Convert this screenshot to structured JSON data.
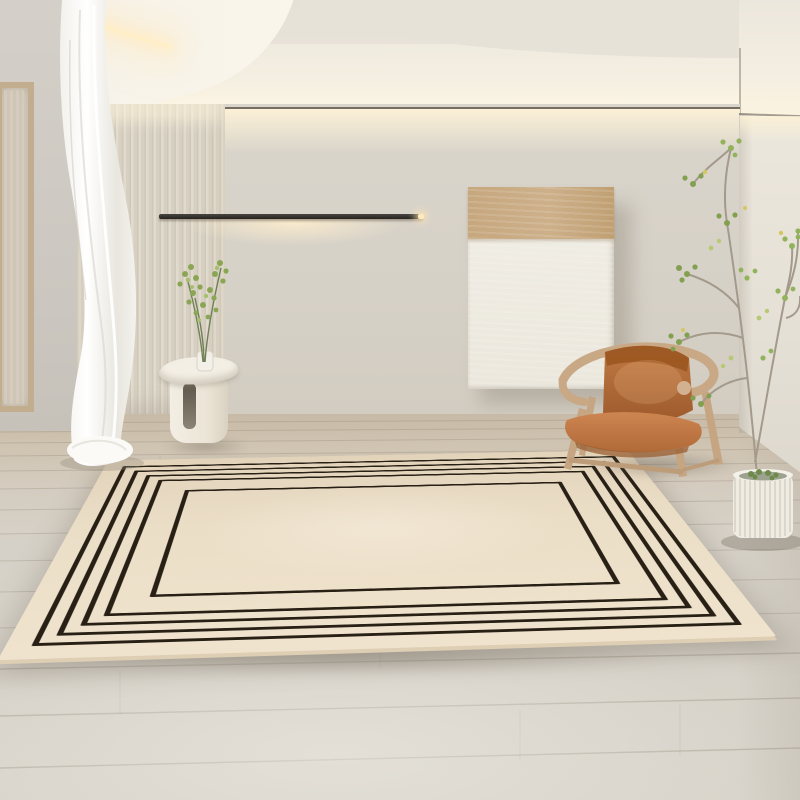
{
  "scene": {
    "label": "Minimalist living room with a cream area rug featuring concentric black rectangular border lines",
    "style": "interior product photograph",
    "visible_text": "none"
  },
  "colors": {
    "ceiling": "#e9e4da",
    "ceiling_fascia": "#f4efe3",
    "soffit": "#f8f4ea",
    "led_glow": "#ffeec6",
    "back_wall": "#d8d3ca",
    "side_wall": "#cfcbc4",
    "right_wall": "#e8e3d9",
    "slat_panel": "#ddd6c8",
    "slat_stripe": "#c9c1b0",
    "wall_lamp": "#35312c",
    "floor_back": "#c8bba7",
    "floor_front": "#d7d3ca",
    "plank_line": "#8e8270",
    "rug_base": "#ebdec7",
    "rug_line": "#281f15",
    "rug_edge": "#ddceb4",
    "canvas_white": "#f0ece2",
    "canvas_tan": "#c7a87f",
    "chair_wood": "#c6a583",
    "chair_leather": "#c07a45",
    "table_white": "#f2ede3",
    "pot_white": "#efece3",
    "leaf_green": "#8aa654",
    "branch": "#a39a8c",
    "curtain_white": "#f7f5f0",
    "window_frame": "#c2ae8e"
  },
  "objects": {
    "rug": {
      "name": "area-rug",
      "shape": "large rectangle seen in perspective",
      "border_line_count": 5,
      "pattern": "concentric thin black rectangular lines on a cream field, wide plain center"
    },
    "wall_lamp": {
      "name": "linear-wall-lamp",
      "state": "on",
      "description": "thin black bar with warm backlight glow"
    },
    "artwork": {
      "name": "leaning-canvas-artwork",
      "panels": [
        "tan textured band on top",
        "white textured field below"
      ]
    },
    "armchair": {
      "name": "wood-frame-leather-armchair",
      "materials": [
        "light wood frame",
        "cognac leather sling back and seat"
      ]
    },
    "side_table": {
      "name": "white-pedestal-side-table",
      "detail": "organic top, vertical slot cutout"
    },
    "small_plant": {
      "name": "green-sprig-in-glass-vase"
    },
    "tall_plant": {
      "name": "potted-tree",
      "pot": "white ribbed cylindrical planter",
      "foliage": "sparse small green leaflets"
    },
    "curtain": {
      "name": "sheer-white-curtain",
      "state": "draped to floor"
    },
    "window": {
      "name": "wood-frame-window",
      "position": "far left, partly hidden by curtain"
    },
    "slat_panel": {
      "name": "vertical-slat-wall-panel"
    },
    "floor": {
      "name": "light-wood-plank-floor",
      "tone": "grey-beige, warmer near back wall"
    },
    "ceiling": {
      "name": "curved-cove-ceiling",
      "lighting": "warm LED cove light"
    }
  }
}
